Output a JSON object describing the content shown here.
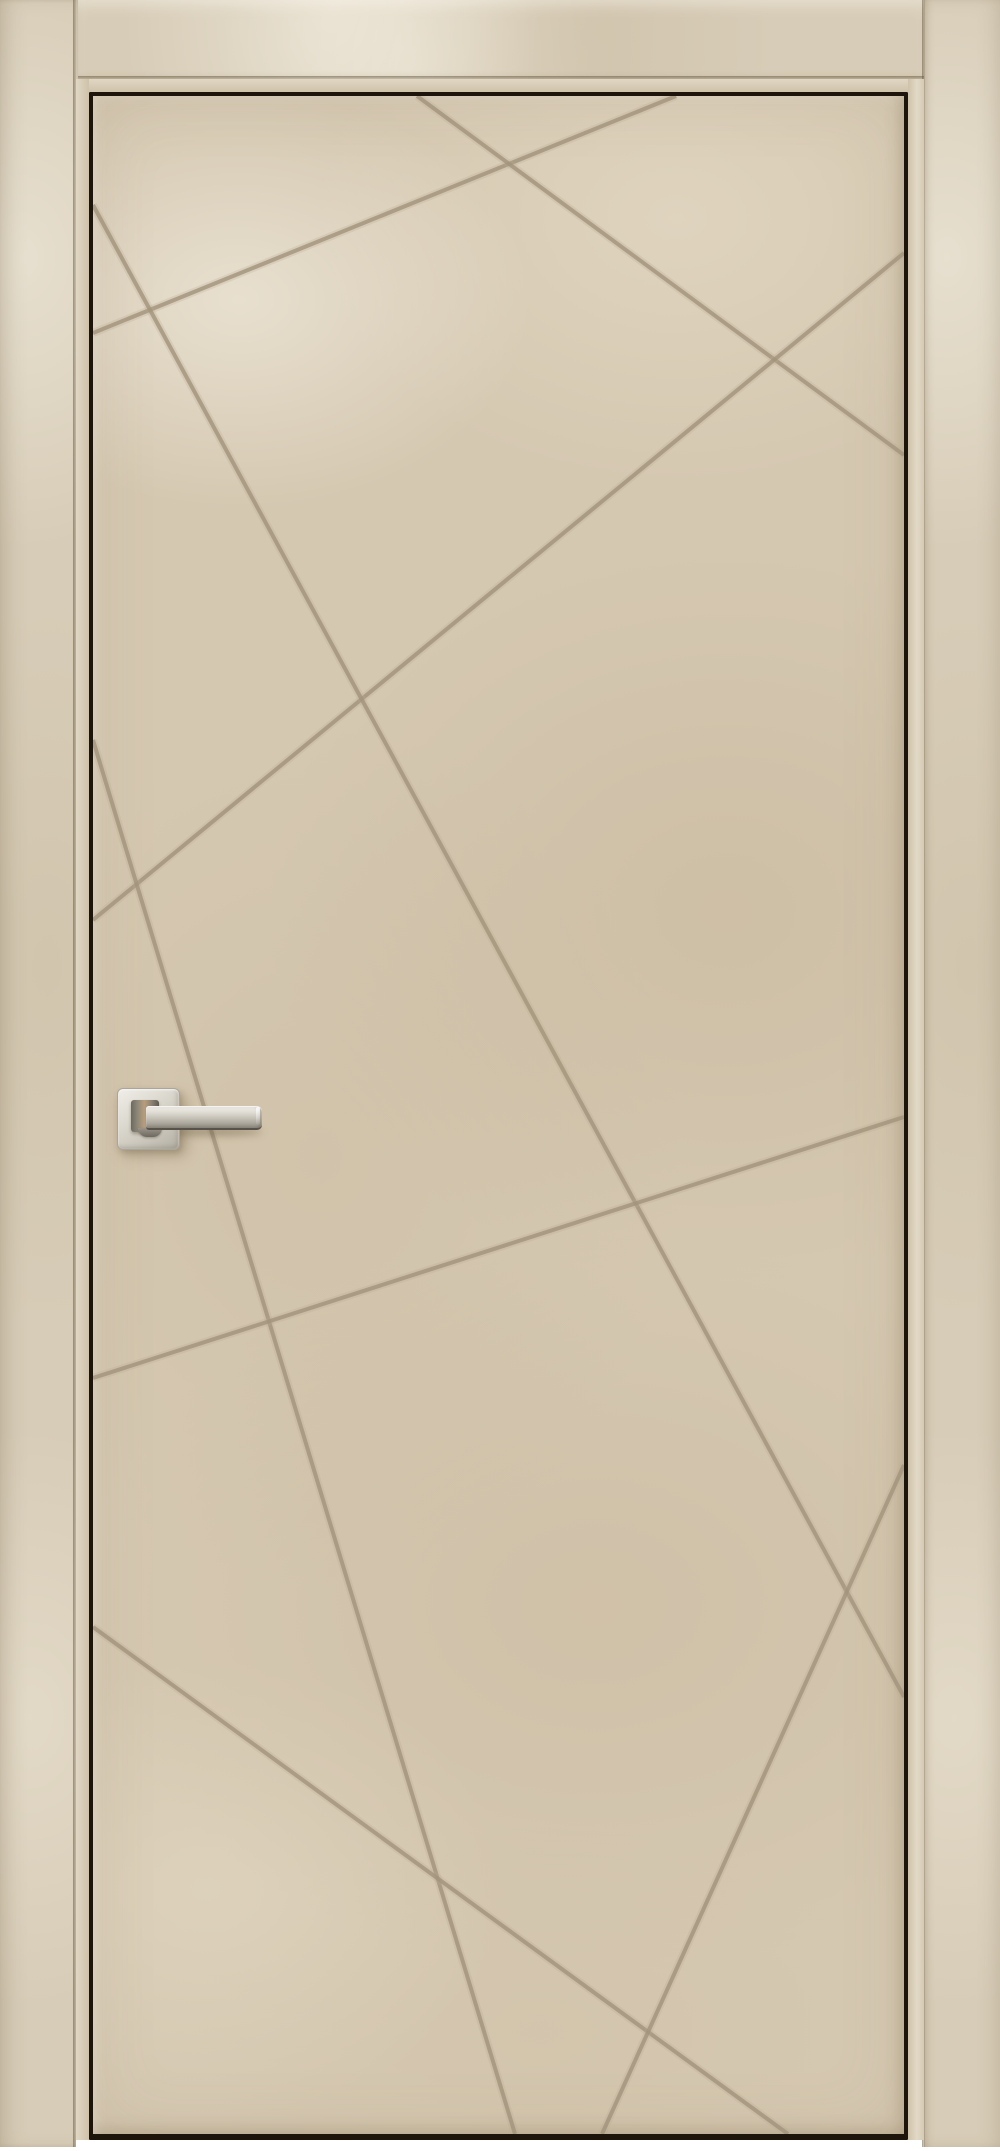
{
  "scene": {
    "description": "Product photo of a closed interior door, beige stone-textured finish, with an engraved pattern of eight straight criss-crossing groove lines and a satin-nickel square-rose lever handle, shown inside a matching beige casing frame on a white background",
    "door_leaf": {
      "left": 93,
      "top": 96,
      "width": 811,
      "height": 2038
    },
    "handle": {
      "type": "lever-handle-on-square-rose",
      "finish": "satin-nickel",
      "side": "left",
      "lever_direction": "right"
    },
    "pattern_lines": [
      {
        "id": "groove-top-shallow",
        "x1": 676,
        "y1": 96,
        "x2": 93,
        "y2": 333
      },
      {
        "id": "groove-top-diagonal",
        "x1": 417,
        "y1": 96,
        "x2": 904,
        "y2": 455
      },
      {
        "id": "groove-upper-cross",
        "x1": 904,
        "y1": 253,
        "x2": 93,
        "y2": 920
      },
      {
        "id": "groove-long-main",
        "x1": 93,
        "y1": 205,
        "x2": 904,
        "y2": 1697
      },
      {
        "id": "groove-handle-steep",
        "x1": 93,
        "y1": 740,
        "x2": 515,
        "y2": 2134
      },
      {
        "id": "groove-mid-shallow",
        "x1": 904,
        "y1": 1117,
        "x2": 93,
        "y2": 1378
      },
      {
        "id": "groove-bottom-diag",
        "x1": 93,
        "y1": 1627,
        "x2": 788,
        "y2": 2134
      },
      {
        "id": "groove-bottom-steep",
        "x1": 904,
        "y1": 1465,
        "x2": 602,
        "y2": 2134
      }
    ]
  },
  "palette": {
    "background_white": "#ffffff",
    "casing_face": "#d7ccb7",
    "jamb_light": "#ddd3bf",
    "gap_dark": "#1d150b",
    "slab_base": "#d5c8b1",
    "pattern_line_soft": "#b7a98f",
    "pattern_line_core": "#a2947d",
    "handle_silver_light": "#f0eee8",
    "handle_silver_dark": "#8c887d",
    "handle_bronze_reflection": "#b89d7c",
    "handle_edge_dark": "#57524a"
  }
}
